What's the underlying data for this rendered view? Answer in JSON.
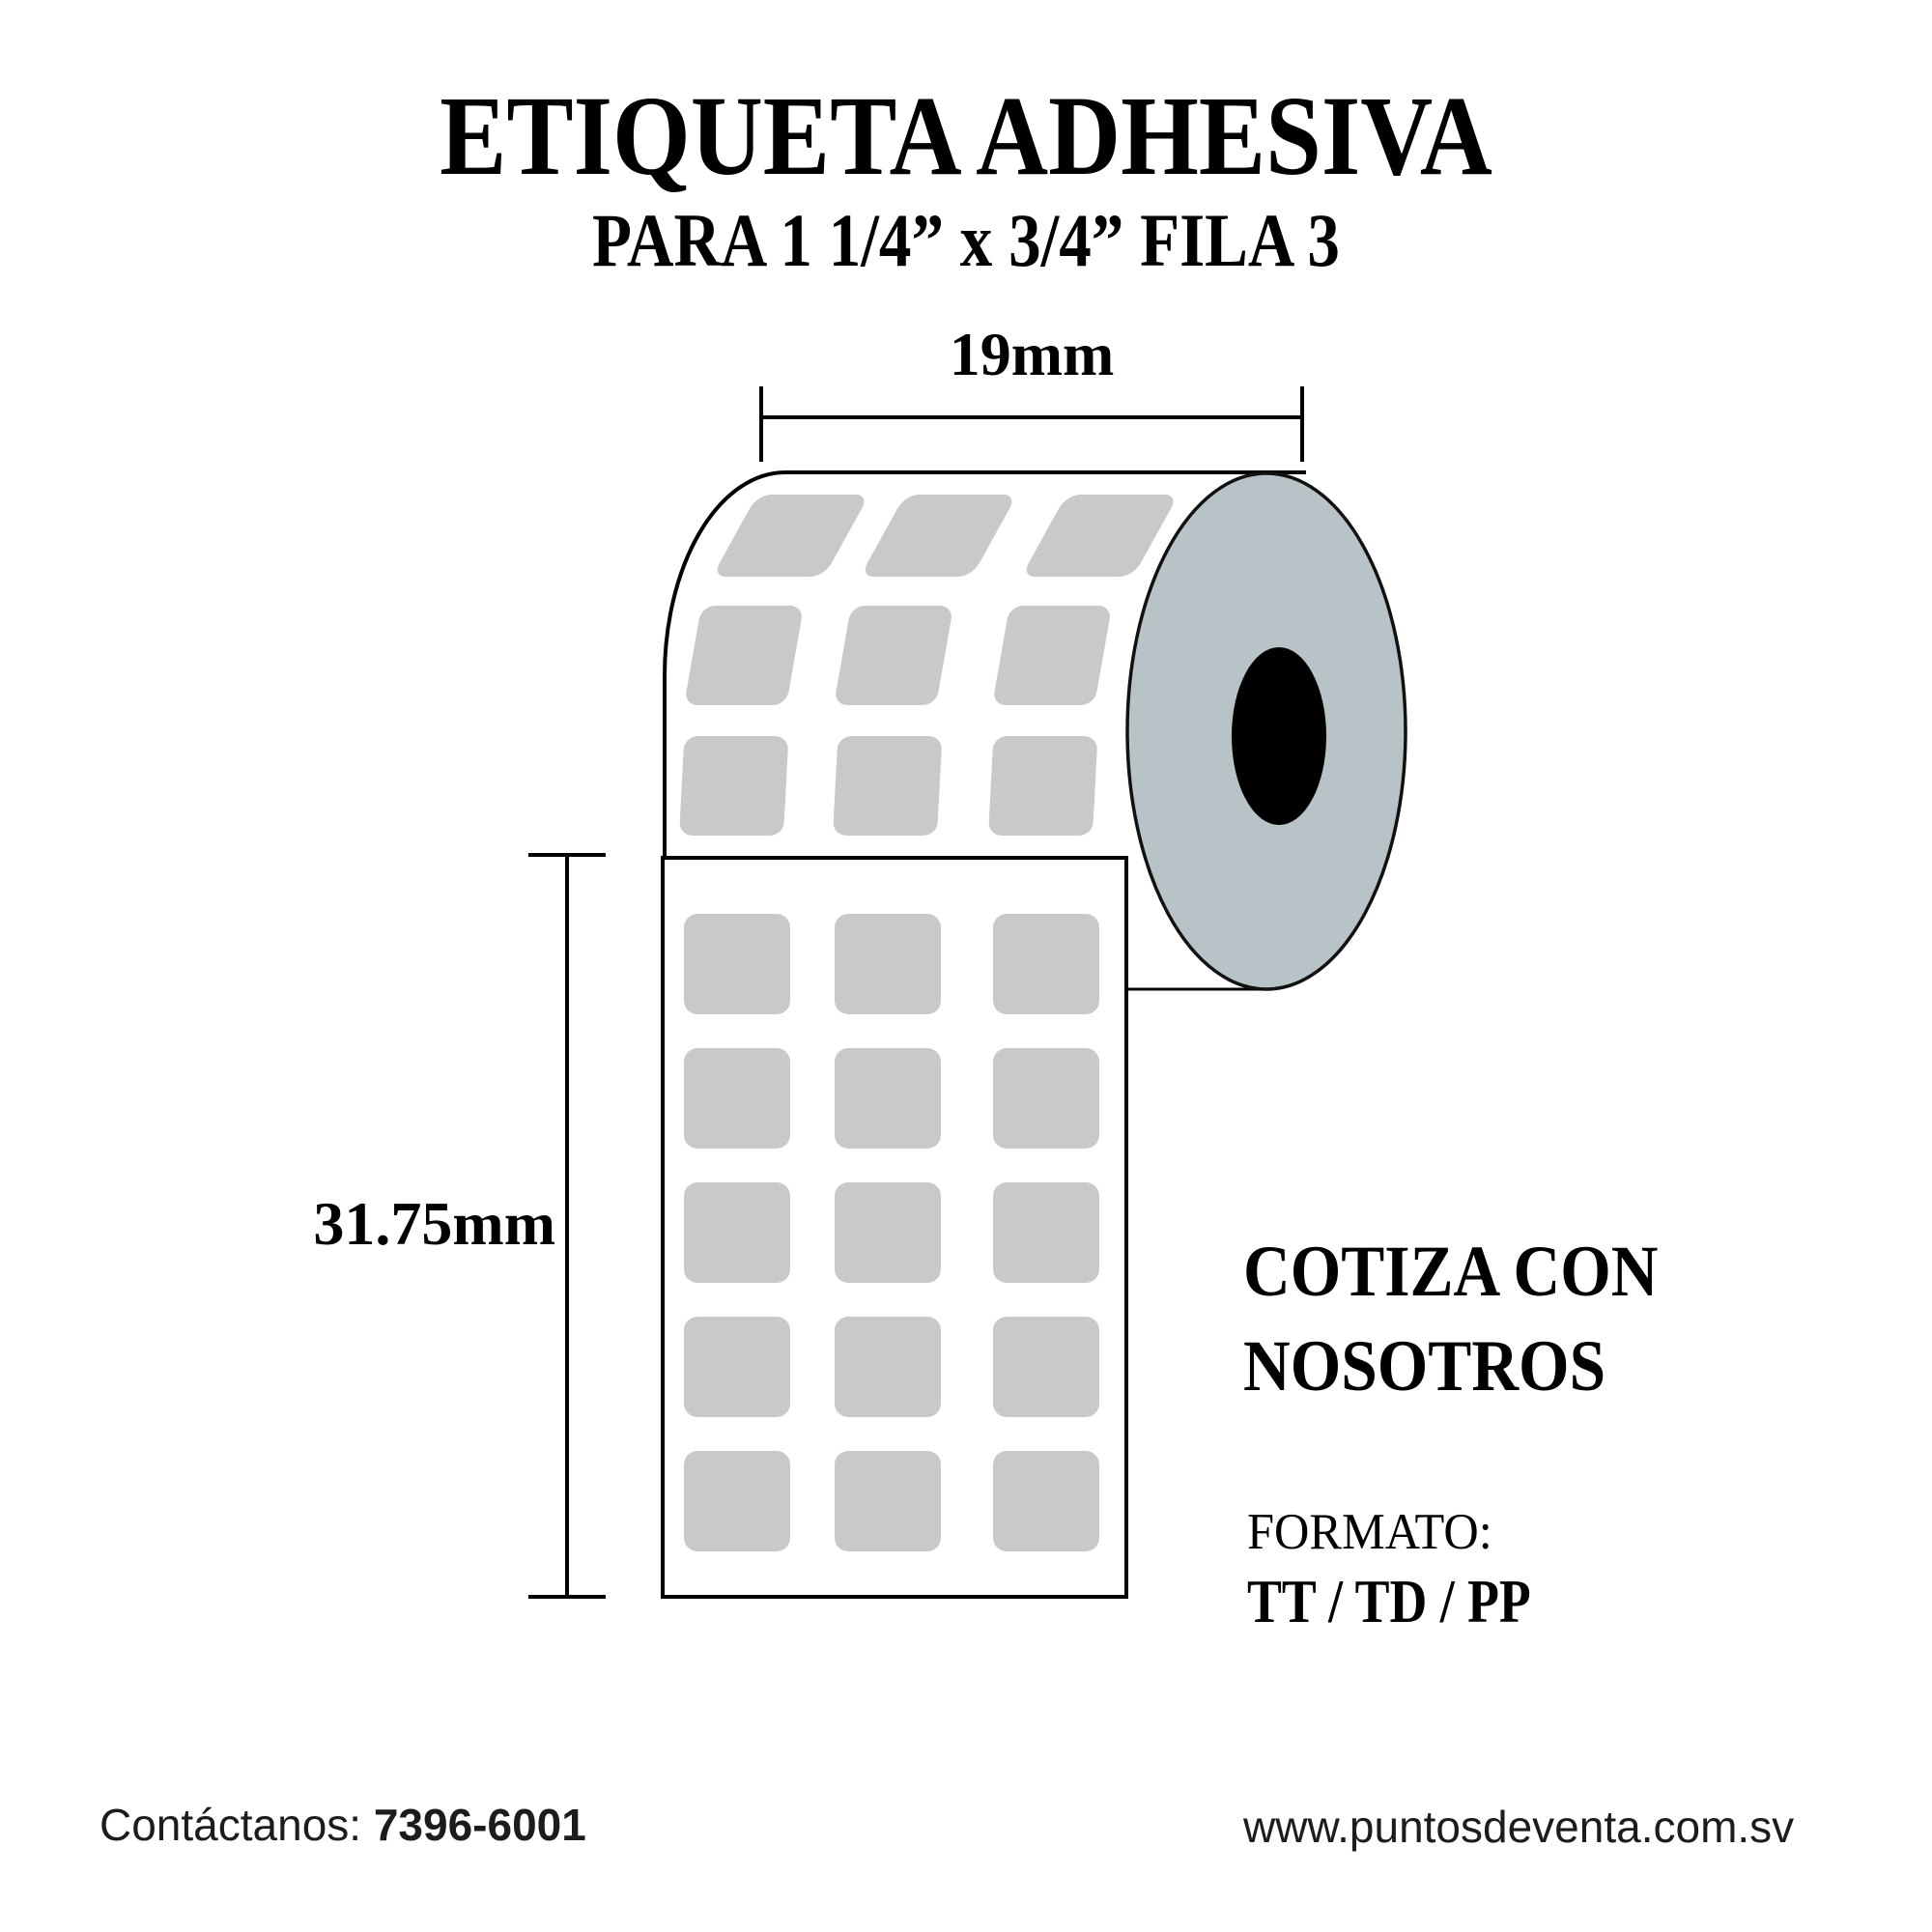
{
  "title": "ETIQUETA ADHESIVA",
  "subtitle": "PARA 1 1/4” x 3/4” FILA 3",
  "dimensions": {
    "width": "19mm",
    "height": "31.75mm"
  },
  "roll": {
    "columns": 3,
    "curved_rows": 3,
    "strip_rows": 5,
    "colors": {
      "sticker": "#c9c9c9",
      "disc_face": "#b8c3c8",
      "core": "#000000",
      "outline": "#000000",
      "backing": "#ffffff"
    }
  },
  "cta": {
    "line1": "COTIZA CON",
    "line2": "NOSOTROS"
  },
  "format": {
    "label": "FORMATO:",
    "value": "TT / TD / PP"
  },
  "footer": {
    "contact_label": "Contáctanos:",
    "contact_number": "7396-6001",
    "website": "www.puntosdeventa.com.sv"
  }
}
